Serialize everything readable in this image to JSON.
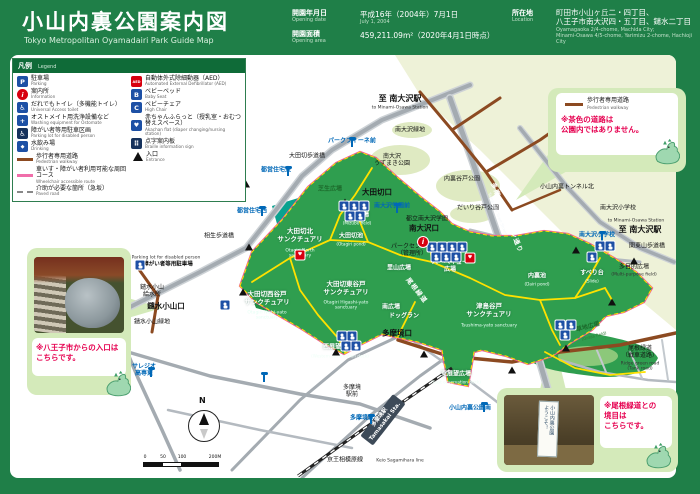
{
  "header": {
    "title": "小山内裏公園案内図",
    "subtitle": "Tokyo Metropolitan Oyamadairi Park Guide Map",
    "opening_date": {
      "label": "開園年月日",
      "label_en": "Opening date",
      "value": "平成16年（2004年）7月1日",
      "value_en": "July 1, 2004"
    },
    "opening_area": {
      "label": "開園面積",
      "label_en": "Opening area",
      "value": "459,211.09m²（2020年4月1日時点）"
    },
    "location": {
      "label": "所在地",
      "label_en": "Location",
      "value_line1": "町田市小山ヶ丘二・四丁目、",
      "value_line2": "八王子市南大沢四・五丁目、鑓水二丁目",
      "value_en_line1": "Oyamagaoka 2/4-chome, Machida City;",
      "value_en_line2": "Minami-Osawa 4/5-chome, Yarimizu 2-chome, Hachioji City"
    }
  },
  "legend": {
    "title": "凡例",
    "title_en": "Legend",
    "left": [
      {
        "jp": "駐車場",
        "en": "Parking",
        "ic": "parking"
      },
      {
        "jp": "案内所",
        "en": "Information",
        "ic": "info"
      },
      {
        "jp": "だれでもトイレ（多機能トイレ）",
        "en": "Universal Access toilet",
        "ic": "toilet"
      },
      {
        "jp": "オストメイト用洗浄設備など",
        "en": "Washing equipment for Ostomate",
        "ic": "ostomate"
      },
      {
        "jp": "障がい者等用駐車区画",
        "en": "Parking lot for disabled person",
        "ic": "disabled-parking"
      },
      {
        "jp": "水飲み場",
        "en": "Drinking",
        "ic": "drinking"
      },
      {
        "jp": "歩行者専用道路",
        "en": "Pedestrian walkway",
        "ic": "line-brown"
      },
      {
        "jp": "車いす・障がい者利用可能な周回コース",
        "en": "Wheelchair accessible route",
        "ic": "line-pink"
      },
      {
        "jp": "介助が必要な箇所（急坂）",
        "en": "Paved road",
        "ic": "line-dashed"
      }
    ],
    "right": [
      {
        "jp": "自動体外式除細動器（AED）",
        "en": "Automated External Defibrillator (AED)",
        "ic": "aed"
      },
      {
        "jp": "ベビーベッド",
        "en": "Baby Seat",
        "ic": "baby-bed"
      },
      {
        "jp": "ベビーチェア",
        "en": "High Chair",
        "ic": "baby-chair"
      },
      {
        "jp": "赤ちゃんふらっと（授乳室・おむつ替えスペース）",
        "en": "Akachan flat (diaper changing/nursing station)",
        "ic": "akachan-flat"
      },
      {
        "jp": "点字案内板",
        "en": "Braille information sign",
        "ic": "braille"
      },
      {
        "jp": "入口",
        "en": "Entrance",
        "ic": "entrance"
      }
    ]
  },
  "callouts": {
    "walkway_note": {
      "line_jp": "歩行者専用道路",
      "line_en": "Pedestrian walkway",
      "note": "※茶色の道路は\n公園内ではありません。"
    },
    "hachioji_entrance": {
      "note": "※八王子市からの入口は\nこちらです。"
    },
    "onekido_boundary": {
      "note": "※尾根緑道との\n境目は\nこちらです。",
      "sign_line1": "ようこそ！",
      "sign_line2": "小山内裏公園"
    }
  },
  "colors": {
    "frame_green": "#1f7f48",
    "park_green": "#2f9e4f",
    "sanctuary_teal": "#0aa28f",
    "route_pink": "#ee5f8e",
    "path_yellow": "#ffe100",
    "walkway_brown": "#8c4a21",
    "bus_blue": "#0068b7",
    "note_red": "#e60050"
  },
  "map": {
    "compass_n": "N",
    "scale_ticks": [
      "0",
      "50",
      "100",
      "200M"
    ],
    "labels": [
      {
        "t": "至 南大沢駅",
        "x": 400,
        "y": 99,
        "c": "dir"
      },
      {
        "t": "to Minami-Osawa Station",
        "x": 400,
        "y": 108,
        "c": "en"
      },
      {
        "t": "南大沢緑地",
        "x": 410,
        "y": 130,
        "c": "pl"
      },
      {
        "t": "南大沢\nうずまき公園",
        "x": 392,
        "y": 160,
        "c": "pl"
      },
      {
        "t": "内裏谷戸公園",
        "x": 462,
        "y": 179,
        "c": "pl"
      },
      {
        "t": "だいり谷戸公園",
        "x": 478,
        "y": 208,
        "c": "pl"
      },
      {
        "t": "都立南大沢学園",
        "x": 427,
        "y": 219,
        "c": "pl"
      },
      {
        "t": "南大沢小学校",
        "x": 618,
        "y": 208,
        "c": "pl"
      },
      {
        "t": "to Minami-Osawa Station",
        "x": 636,
        "y": 221,
        "c": "en"
      },
      {
        "t": "至 南大沢駅",
        "x": 640,
        "y": 230,
        "c": "dir"
      },
      {
        "t": "関東山歩道橋",
        "x": 647,
        "y": 246,
        "c": "pl"
      },
      {
        "t": "小山内裏トンネル北",
        "x": 567,
        "y": 187,
        "c": "pl"
      },
      {
        "t": "大田切歩道橋",
        "x": 307,
        "y": 156,
        "c": "pl"
      },
      {
        "t": "相生歩道橋",
        "x": 219,
        "y": 236,
        "c": "pl"
      },
      {
        "t": "都営住宅東",
        "x": 276,
        "y": 170,
        "c": "bus"
      },
      {
        "t": "都営住宅西",
        "x": 252,
        "y": 211,
        "c": "bus"
      },
      {
        "t": "パークフィーネ前",
        "x": 352,
        "y": 141,
        "c": "bus"
      },
      {
        "t": "南大沢学園前",
        "x": 392,
        "y": 206,
        "c": "bus"
      },
      {
        "t": "南大沢小学校",
        "x": 597,
        "y": 235,
        "c": "bus"
      },
      {
        "t": "多摩境駅",
        "x": 362,
        "y": 418,
        "c": "bus"
      },
      {
        "t": "サレジオ\n高専東",
        "x": 144,
        "y": 370,
        "c": "bus"
      },
      {
        "t": "小山内裏公園南",
        "x": 470,
        "y": 408,
        "c": "bus"
      },
      {
        "t": "鑓水小山\n給水所",
        "x": 152,
        "y": 291,
        "c": "pl"
      },
      {
        "t": "鑓水小山口",
        "x": 166,
        "y": 306,
        "c": "plb"
      },
      {
        "t": "鑓水小山緑地",
        "x": 152,
        "y": 322,
        "c": "pl"
      },
      {
        "t": "多摩境\n駅前",
        "x": 352,
        "y": 391,
        "c": "pl"
      },
      {
        "t": "多摩境口",
        "x": 397,
        "y": 333,
        "c": "plb"
      },
      {
        "t": "大田切口",
        "x": 377,
        "y": 192,
        "c": "plb"
      },
      {
        "t": "南大沢口",
        "x": 424,
        "y": 228,
        "c": "plb"
      },
      {
        "t": "大田切北\nサンクチュアリ",
        "x": 300,
        "y": 236,
        "c": "san"
      },
      {
        "t": "Otagiri North\nsanctuary",
        "x": 300,
        "y": 254,
        "c": "sanen"
      },
      {
        "t": "大田切西谷戸\nサンクチュアリ",
        "x": 267,
        "y": 299,
        "c": "san"
      },
      {
        "t": "Otagiri Nishi-yato\nsanctuary",
        "x": 267,
        "y": 316,
        "c": "sanen"
      },
      {
        "t": "大田切東谷戸\nサンクチュアリ",
        "x": 346,
        "y": 289,
        "c": "san"
      },
      {
        "t": "Otagiri Higashi-yato\nsanctuary",
        "x": 346,
        "y": 306,
        "c": "sanen"
      },
      {
        "t": "津島谷戸\nサンクチュアリ",
        "x": 489,
        "y": 311,
        "c": "san"
      },
      {
        "t": "Tsushima-yato sanctuary",
        "x": 489,
        "y": 326,
        "c": "sanen"
      },
      {
        "t": "水辺広場",
        "x": 357,
        "y": 215,
        "c": "wht"
      },
      {
        "t": "(Mizube field)",
        "x": 357,
        "y": 223,
        "c": "whten"
      },
      {
        "t": "大田切池",
        "x": 351,
        "y": 236,
        "c": "wht"
      },
      {
        "t": "(Otagiri pond)",
        "x": 351,
        "y": 244,
        "c": "whten"
      },
      {
        "t": "芝生広場",
        "x": 330,
        "y": 189,
        "c": "grn"
      },
      {
        "t": "パークセンター\n（管理所）",
        "x": 412,
        "y": 250,
        "c": "pl"
      },
      {
        "t": "里山広場",
        "x": 399,
        "y": 268,
        "c": "wht"
      },
      {
        "t": "バーベキュー\n広場",
        "x": 450,
        "y": 266,
        "c": "wht"
      },
      {
        "t": "南広場",
        "x": 391,
        "y": 307,
        "c": "wht"
      },
      {
        "t": "ドッグラン",
        "x": 404,
        "y": 316,
        "c": "wht"
      },
      {
        "t": "すべり台",
        "x": 592,
        "y": 273,
        "c": "wht"
      },
      {
        "t": "(Slide)",
        "x": 592,
        "y": 281,
        "c": "whten"
      },
      {
        "t": "多目的広場",
        "x": 634,
        "y": 267,
        "c": "pl"
      },
      {
        "t": "(Multi-purpose field)",
        "x": 634,
        "y": 275,
        "c": "en"
      },
      {
        "t": "内裏池",
        "x": 537,
        "y": 276,
        "c": "wht"
      },
      {
        "t": "(Dairi pond)",
        "x": 537,
        "y": 284,
        "c": "whten"
      },
      {
        "t": "西展望広場",
        "x": 338,
        "y": 347,
        "c": "wht"
      },
      {
        "t": "(Western observation deck)",
        "x": 340,
        "y": 356,
        "c": "whten"
      },
      {
        "t": "東展望広場",
        "x": 456,
        "y": 374,
        "c": "wht"
      },
      {
        "t": "(East observation deck)",
        "x": 456,
        "y": 382,
        "c": "whten"
      },
      {
        "t": "草地広場",
        "x": 588,
        "y": 327,
        "c": "grn",
        "r": -15
      },
      {
        "t": "(Grass field)",
        "x": 594,
        "y": 336,
        "c": "grnen",
        "r": -15
      },
      {
        "t": "多摩ニュータウン通り",
        "x": 506,
        "y": 218,
        "c": "road",
        "r": 68
      },
      {
        "t": "Tama New Town Street",
        "x": 497,
        "y": 214,
        "c": "roaden",
        "r": 68
      },
      {
        "t": "尾根緑道",
        "x": 416,
        "y": 291,
        "c": "road",
        "r": 52
      },
      {
        "t": "尾根緑道\n（戦車道路）",
        "x": 640,
        "y": 352,
        "c": "pl"
      },
      {
        "t": "Ridge green road\n(Tank road)",
        "x": 640,
        "y": 367,
        "c": "en"
      },
      {
        "t": "京王相模原線",
        "x": 345,
        "y": 460,
        "c": "pl"
      },
      {
        "t": "Keio Sagamihara line",
        "x": 400,
        "y": 461,
        "c": "en"
      },
      {
        "t": "Parking lot for disabled person",
        "x": 166,
        "y": 258,
        "c": "en"
      },
      {
        "t": "障がい者等用駐車場",
        "x": 168,
        "y": 265,
        "c": "plsm"
      },
      {
        "t": "多摩境駅\nTamasakai Sta.",
        "x": 383,
        "y": 420,
        "c": "sta",
        "r": -52
      }
    ],
    "markers": {
      "ent": [
        [
          246,
          184
        ],
        [
          249,
          247
        ],
        [
          345,
          202
        ],
        [
          428,
          244
        ],
        [
          576,
          250
        ],
        [
          634,
          261
        ],
        [
          612,
          302
        ],
        [
          566,
          348
        ],
        [
          512,
          370
        ],
        [
          424,
          354
        ],
        [
          336,
          352
        ],
        [
          243,
          292
        ]
      ],
      "bus": [
        [
          288,
          176
        ],
        [
          262,
          216
        ],
        [
          352,
          147
        ],
        [
          397,
          213
        ],
        [
          602,
          241
        ],
        [
          371,
          424
        ],
        [
          151,
          377
        ],
        [
          484,
          412
        ],
        [
          264,
          382
        ]
      ],
      "icon": [
        [
          344,
          206
        ],
        [
          354,
          206
        ],
        [
          364,
          206
        ],
        [
          350,
          216
        ],
        [
          360,
          216
        ],
        [
          432,
          247
        ],
        [
          442,
          247
        ],
        [
          452,
          247
        ],
        [
          462,
          247
        ],
        [
          436,
          257
        ],
        [
          446,
          257
        ],
        [
          456,
          257
        ],
        [
          600,
          246
        ],
        [
          610,
          246
        ],
        [
          592,
          257
        ],
        [
          342,
          336
        ],
        [
          352,
          336
        ],
        [
          346,
          346
        ],
        [
          356,
          346
        ],
        [
          560,
          325
        ],
        [
          571,
          325
        ],
        [
          565,
          335
        ],
        [
          225,
          305
        ],
        [
          140,
          265
        ]
      ],
      "aed": [
        [
          300,
          255
        ],
        [
          470,
          258
        ]
      ],
      "info": [
        [
          423,
          242
        ]
      ]
    }
  }
}
